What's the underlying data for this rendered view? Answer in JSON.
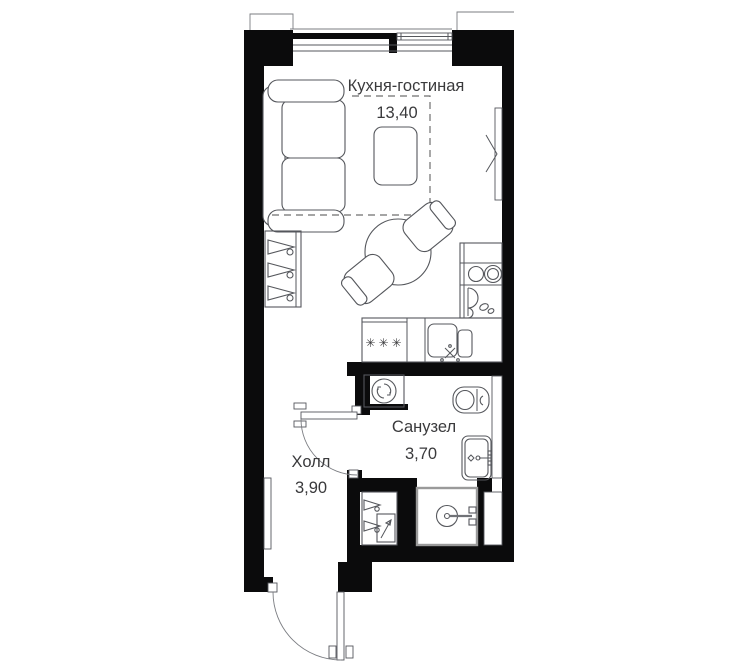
{
  "plan": {
    "rooms": [
      {
        "id": "kitchen-living",
        "name": "Кухня-гостиная",
        "area": "13,40"
      },
      {
        "id": "bathroom",
        "name": "Санузел",
        "area": "3,70"
      },
      {
        "id": "hall",
        "name": "Холл",
        "area": "3,90"
      }
    ],
    "kitchen": {
      "hob_marks": "✳✳✳"
    },
    "colors": {
      "wall": "#0b0b0c",
      "furniture_line": "#55575c",
      "glass_line": "#9a9a9a",
      "dashed_zone": "#6f6f6f",
      "text": "#3a3a3c",
      "background": "#ffffff"
    }
  }
}
